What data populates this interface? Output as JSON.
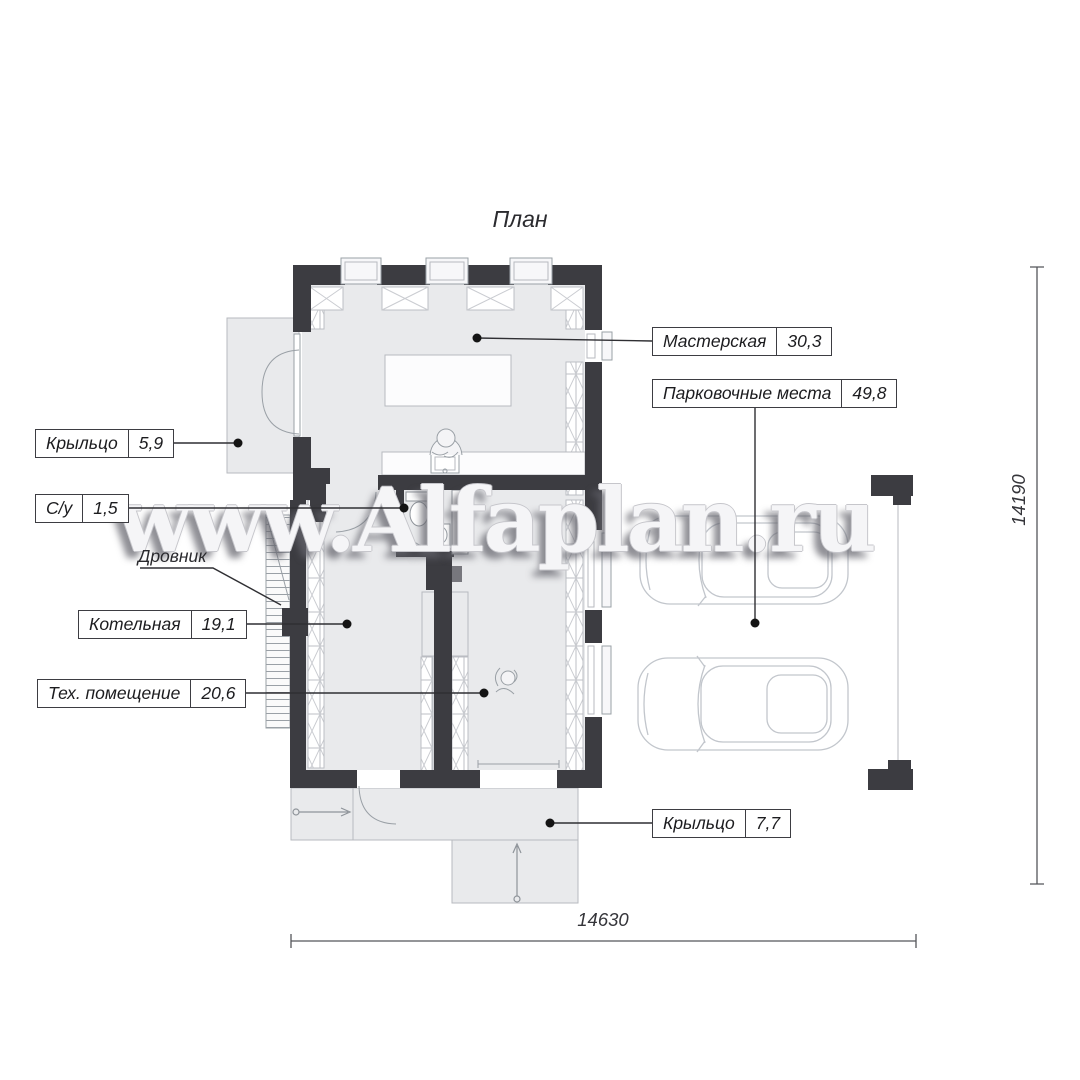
{
  "title": "План",
  "watermark": "www.Alfaplan.ru",
  "rooms": {
    "porch_top": {
      "label": "Крыльцо",
      "area": "5,9"
    },
    "wc": {
      "label": "С/у",
      "area": "1,5"
    },
    "woodshed": {
      "label": "Дровник"
    },
    "boiler_room": {
      "label": "Котельная",
      "area": "19,1"
    },
    "tech_room": {
      "label": "Тех. помещение",
      "area": "20,6"
    },
    "workshop": {
      "label": "Мастерская",
      "area": "30,3"
    },
    "parking": {
      "label": "Парковочные места",
      "area": "49,8"
    },
    "porch_bottom": {
      "label": "Крыльцо",
      "area": "7,7"
    }
  },
  "dimensions": {
    "overall_width": "14630",
    "overall_height": "14190"
  },
  "colors": {
    "wall": "#3c3c41",
    "floor": "#e9eaec",
    "thin_line": "#9aa0a6",
    "leader_line": "#2f2f33",
    "label_border": "#3d3d42",
    "watermark_face": "#f5f5f7"
  }
}
